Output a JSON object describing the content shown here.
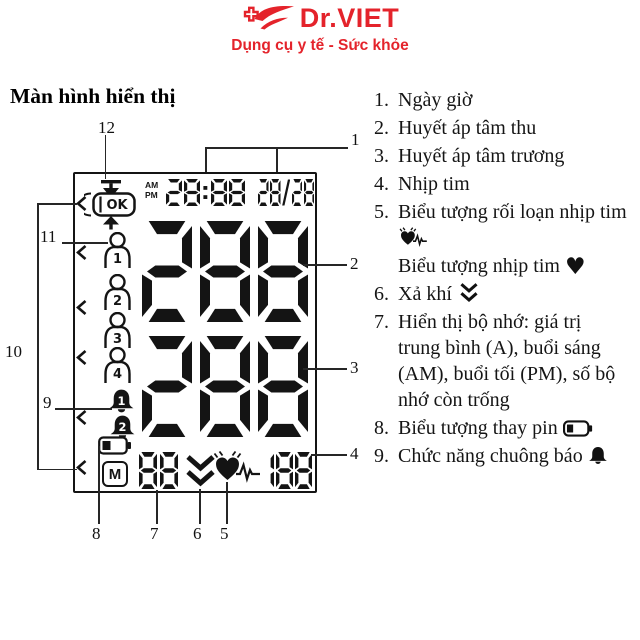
{
  "header": {
    "brand": "Dr.VIET",
    "tagline": "Dụng cụ y tế - Sức khỏe"
  },
  "colors": {
    "brand_red": "#e4232b",
    "ink": "#151515"
  },
  "section_title": "Màn hình hiển thị",
  "lcd": {
    "ok": "OK",
    "am": "AM",
    "pm": "PM",
    "time": "28:88",
    "date": "28/28",
    "systolic": "288",
    "diastolic": "288",
    "memory_m": "M",
    "memory_count": "88",
    "pulse": "188",
    "users": [
      "1",
      "2",
      "3",
      "4"
    ],
    "alarms": [
      "1",
      "2"
    ]
  },
  "callouts": {
    "c1": "1",
    "c2": "2",
    "c3": "3",
    "c4": "4",
    "c5": "5",
    "c6": "6",
    "c7": "7",
    "c8": "8",
    "c9": "9",
    "c10": "10",
    "c11": "11",
    "c12": "12"
  },
  "legend": {
    "items": [
      {
        "num": "1.",
        "text": "Ngày giờ"
      },
      {
        "num": "2.",
        "text": "Huyết áp tâm thu"
      },
      {
        "num": "3.",
        "text": "Huyết áp tâm trương"
      },
      {
        "num": "4.",
        "text": "Nhịp tim"
      },
      {
        "num": "5.",
        "text": "Biểu tượng rối loạn nhịp tim",
        "text2": "Biểu tượng nhịp tim"
      },
      {
        "num": "6.",
        "text": "Xả khí"
      },
      {
        "num": "7.",
        "text": "Hiển thị bộ nhớ: giá trị trung bình (A), buổi sáng (AM), buổi tối (PM), số bộ nhớ còn trống"
      },
      {
        "num": "8.",
        "text": "Biểu tượng thay pin"
      },
      {
        "num": "9.",
        "text": "Chức năng chuông báo"
      }
    ]
  }
}
